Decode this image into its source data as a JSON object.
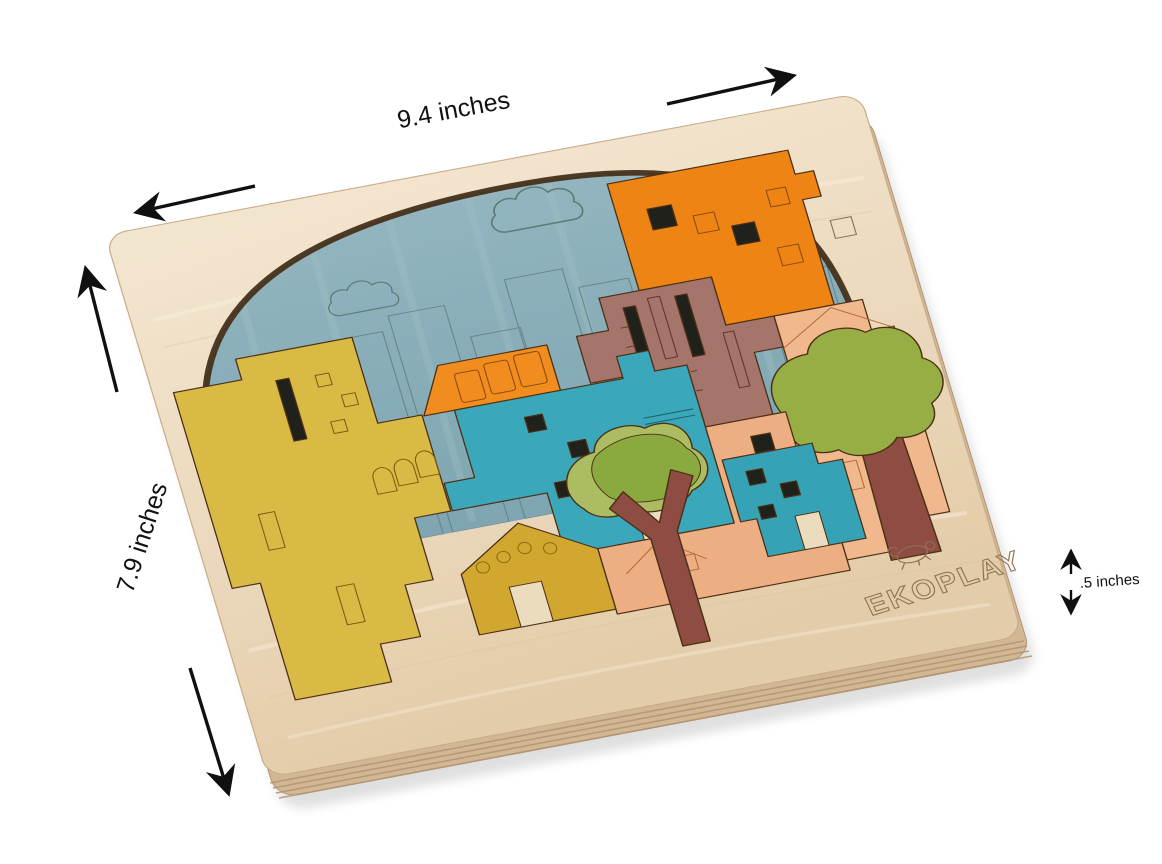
{
  "scene": {
    "type": "product-photo",
    "subject": "EKOPLAY wooden city skyline jigsaw puzzle board, tilted in perspective, with black dimension arrows",
    "background": "#ffffff"
  },
  "annotations": {
    "width_label": "9.4 inches",
    "height_label": "7.9 inches",
    "thickness_label": ".5 inches"
  },
  "brand": {
    "logo_text": "EKOPLAY",
    "logo_icon": "turtle-icon"
  },
  "board": {
    "shape": "rounded rectangle plywood tray with arched recess",
    "recess": "dome arch filled with blue sky backdrop engraved with clouds and city skyline",
    "edge": "laminated plywood layers visible along bottom edge"
  },
  "colors": {
    "background": "#ffffff",
    "wood_light": "#f3e6d0",
    "wood": "#ebd8bd",
    "wood_dark": "#e1caa8",
    "wood_side": "#d2b795",
    "wood_side_line": "#b1946f",
    "board_outline": "#c9ac88",
    "recess_shadow": "#45301a",
    "sky": "#87acb8",
    "sky_streak": "#a6c3c6",
    "engrave_sky": "#64807f",
    "engrave_wood": "#8d7252",
    "piece_outline": "#4c3014",
    "cut_dark": "#20211a",
    "door_wood": "#ecdcbe",
    "arrow": "#101010",
    "label": "#111111",
    "yellow": "#d8ba45",
    "house_yellow": "#d2a72f",
    "orange": "#f18c1e",
    "orange_big": "#ee8414",
    "teal": "#3ba7bb",
    "teal_right": "#36a2b5",
    "mauve": "#a5746b",
    "maroon": "#8e4c42",
    "salmon": "#f1b88d",
    "salmon_deep": "#eeae83",
    "green": "#97ae45",
    "green_light": "#abbc63",
    "green_dark": "#8aa93e"
  },
  "pieces": [
    {
      "name": "yellow-tall-building",
      "color": "#d8ba45"
    },
    {
      "name": "yellow-gabled-house",
      "color": "#d2a72f"
    },
    {
      "name": "orange-awning-house",
      "color": "#f18c1e"
    },
    {
      "name": "orange-big-building",
      "color": "#ee8414"
    },
    {
      "name": "mauve-slot-building",
      "color": "#a5746b"
    },
    {
      "name": "teal-center-building",
      "color": "#3ba7bb"
    },
    {
      "name": "teal-right-building",
      "color": "#36a2b5"
    },
    {
      "name": "salmon-right-building",
      "color": "#f1b88d"
    },
    {
      "name": "salmon-bottom-building",
      "color": "#eeae83"
    },
    {
      "name": "big-tree",
      "color": "#97ae45"
    },
    {
      "name": "small-tree",
      "color": "#abbc63"
    },
    {
      "name": "tree-trunks",
      "color": "#8e4c42"
    }
  ]
}
